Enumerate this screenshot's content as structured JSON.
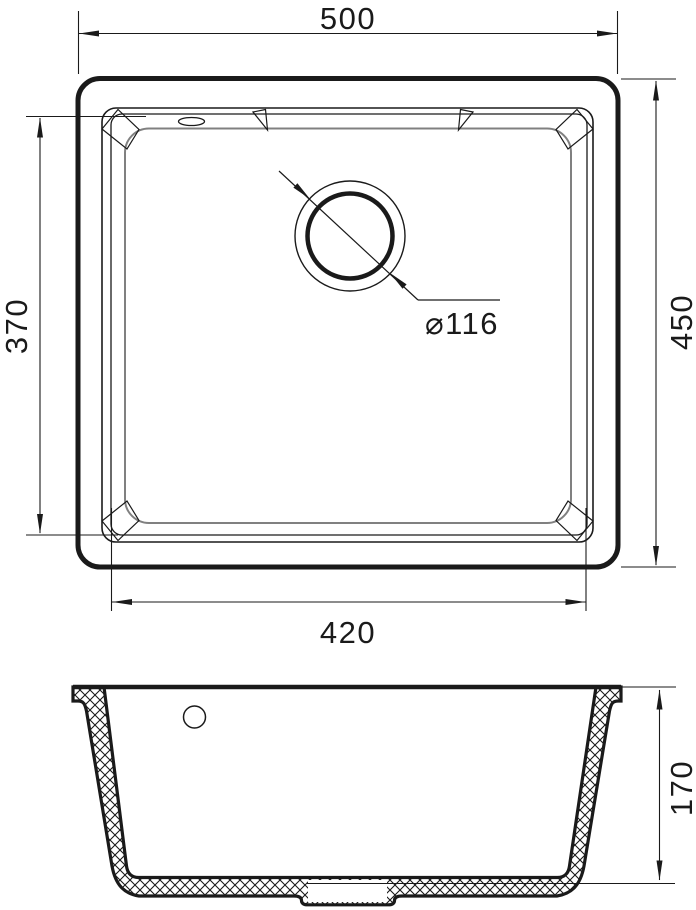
{
  "drawing": {
    "kind": "sink-technical-drawing",
    "views": {
      "top_view": "plan view of sink",
      "section_view": "front cross-section"
    }
  },
  "dimensions": {
    "overall_width": "500",
    "overall_depth": "450",
    "bowl_depth_side": "370",
    "bowl_width": "420",
    "drain_diameter": "⌀116",
    "bowl_height": "170"
  },
  "colors": {
    "line": "#1a1a1a",
    "basin_edge": "#808080",
    "background": "#ffffff"
  }
}
